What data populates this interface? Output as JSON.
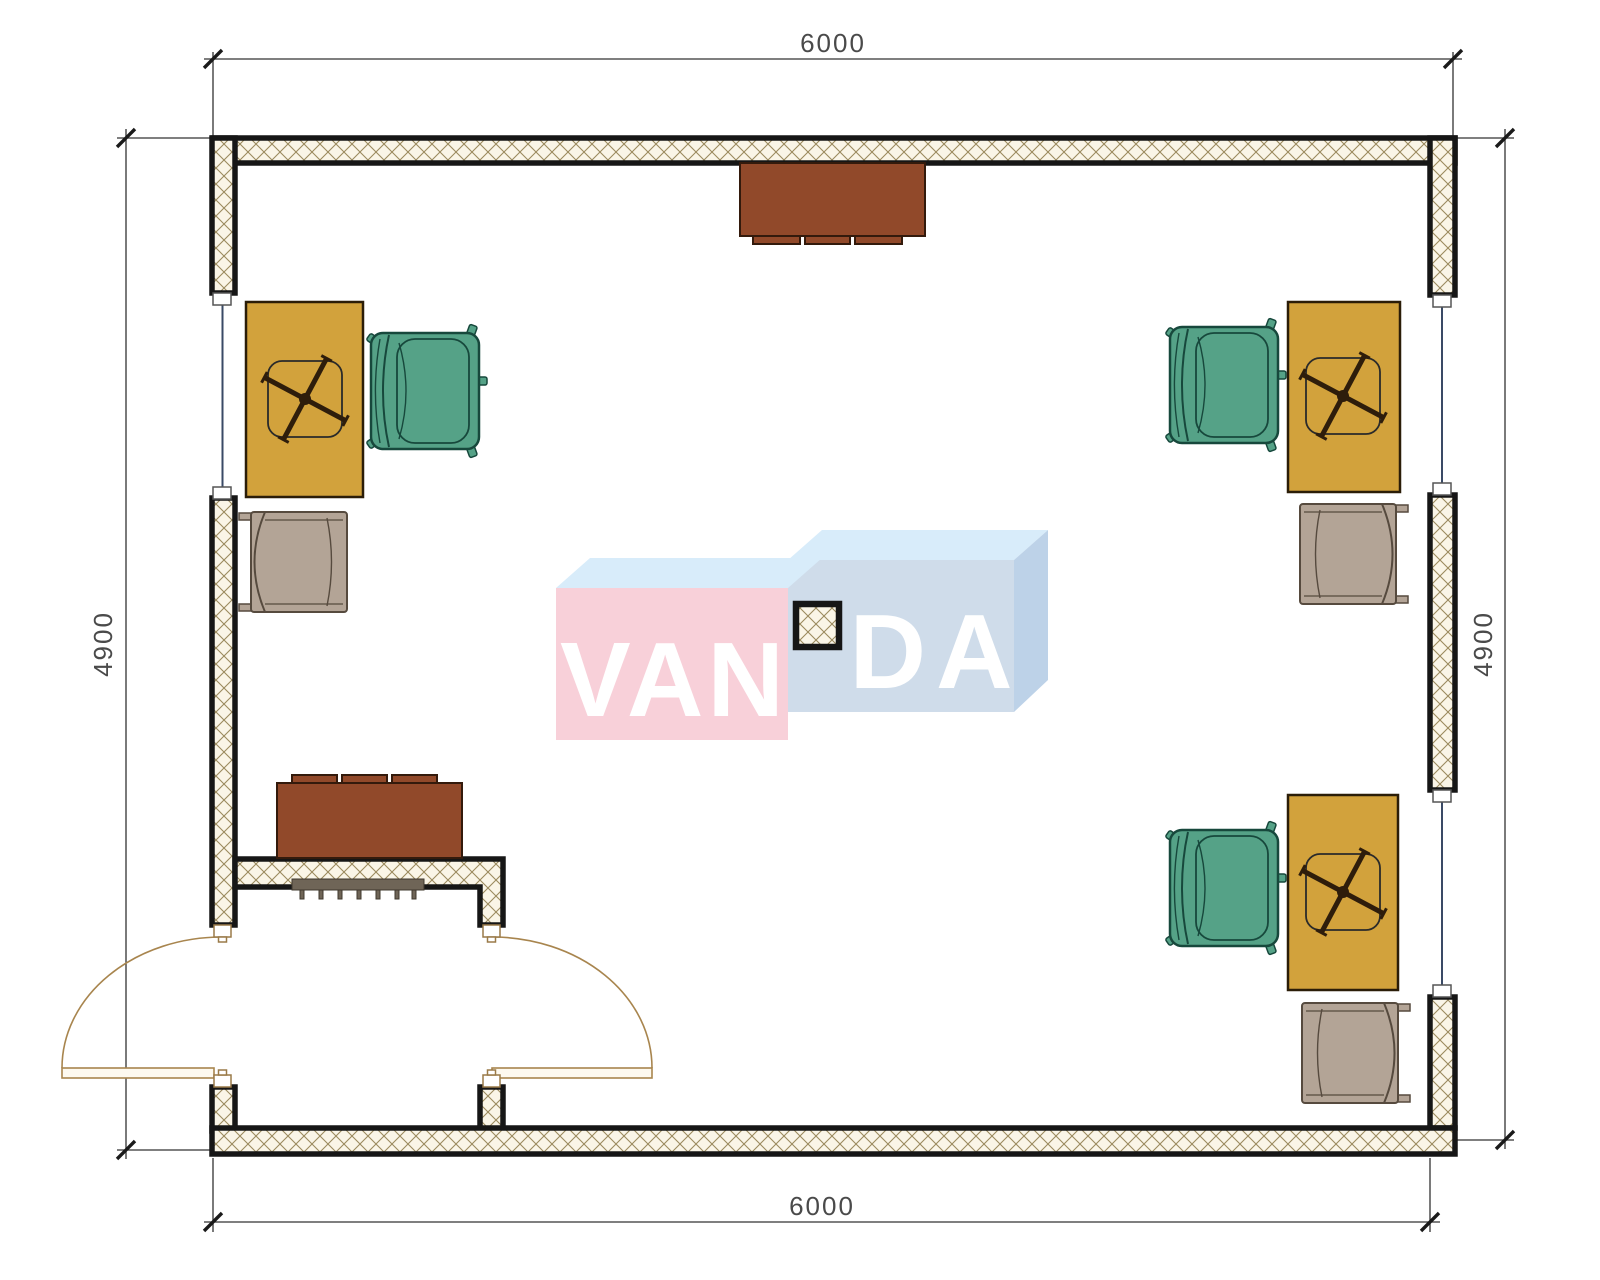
{
  "document": {
    "type": "architectural-floor-plan",
    "room": "office with recessed entrance"
  },
  "dimensions": {
    "top": "6000",
    "bottom": "6000",
    "left": "4900",
    "right": "4900"
  },
  "watermark": {
    "left": "VAN",
    "right": "DA"
  },
  "furniture": {
    "desks": "3 desks with swivel-chair base symbol",
    "armchairs": "3 green office armchairs",
    "side_chairs": "3 gray visitor chairs",
    "cabinets": "2 brown cabinets",
    "radiator": "radiator grille at entrance wall",
    "column": "hatched center column",
    "doors": "double outward-swinging entrance doors"
  },
  "colors": {
    "wall_line": "#161616",
    "hatch_bg": "#faf5e7",
    "hatch_line": "#9b8a5e",
    "window_line": "#3a4a66",
    "door": "#a8854e",
    "door_leaf_fill": "#fdf9ef",
    "dim_line": "#333333",
    "desk": "#d2a23c",
    "desk_edge": "#2b1d08",
    "chair_green": "#55a287",
    "chair_green_edge": "#17483c",
    "chair_gray": "#b3a496",
    "chair_gray_edge": "#564a3e",
    "cabinet_brown": "#91492a",
    "cabinet_brown_edge": "#331a0c",
    "radiator": "#6f6557",
    "logo_pink": "#f8d0d9",
    "logo_blue_front": "#cfdcea",
    "logo_blue_top": "#d8ecfa",
    "logo_blue_side": "#bdd2e8",
    "logo_text": "#ffffff"
  }
}
